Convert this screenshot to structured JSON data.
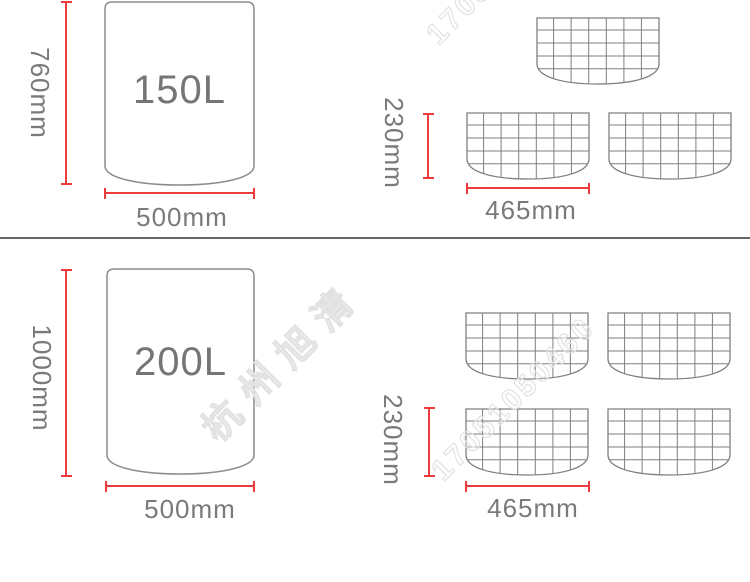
{
  "top_section": {
    "tank": {
      "volume": "150L",
      "height": "760mm",
      "diameter": "500mm"
    },
    "mesh": {
      "height": "230mm",
      "width": "465mm",
      "panel_count": 3
    }
  },
  "bottom_section": {
    "tank": {
      "volume": "200L",
      "height": "1000mm",
      "diameter": "500mm"
    },
    "mesh": {
      "height": "230mm",
      "width": "465mm",
      "panel_count": 4
    }
  },
  "watermark": {
    "brand": "杭州旭清",
    "phone": "17051050460"
  },
  "colors": {
    "dimension_red": "#ee3c3c",
    "outline_gray": "#828282",
    "text_gray": "#757575",
    "divider_gray": "#676767",
    "watermark_gray": "#e2e2e2"
  }
}
